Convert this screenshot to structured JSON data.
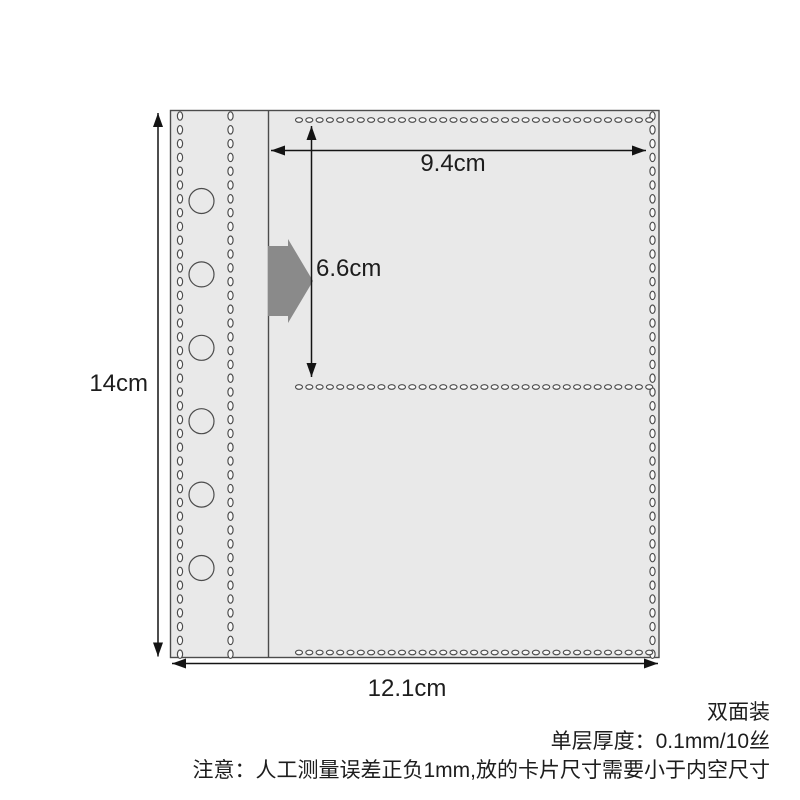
{
  "product_diagram": {
    "dimension_labels": {
      "page_height": "14cm",
      "page_width": "12.1cm",
      "pocket_width": "9.4cm",
      "pocket_height": "6.6cm"
    },
    "notes": {
      "binding": "双面装",
      "thickness": "单层厚度：0.1mm/10丝",
      "caution": "注意：人工测量误差正负1mm,放的卡片尺寸需要小于内空尺寸"
    },
    "colors": {
      "page_fill": "#e9e9e9",
      "outline": "#4c4c4c",
      "stitch_fill": "#fafafa",
      "dimension_line": "#141414",
      "insert_arrow_fill": "#8a8a8a",
      "text": "#1d1d1d"
    }
  }
}
